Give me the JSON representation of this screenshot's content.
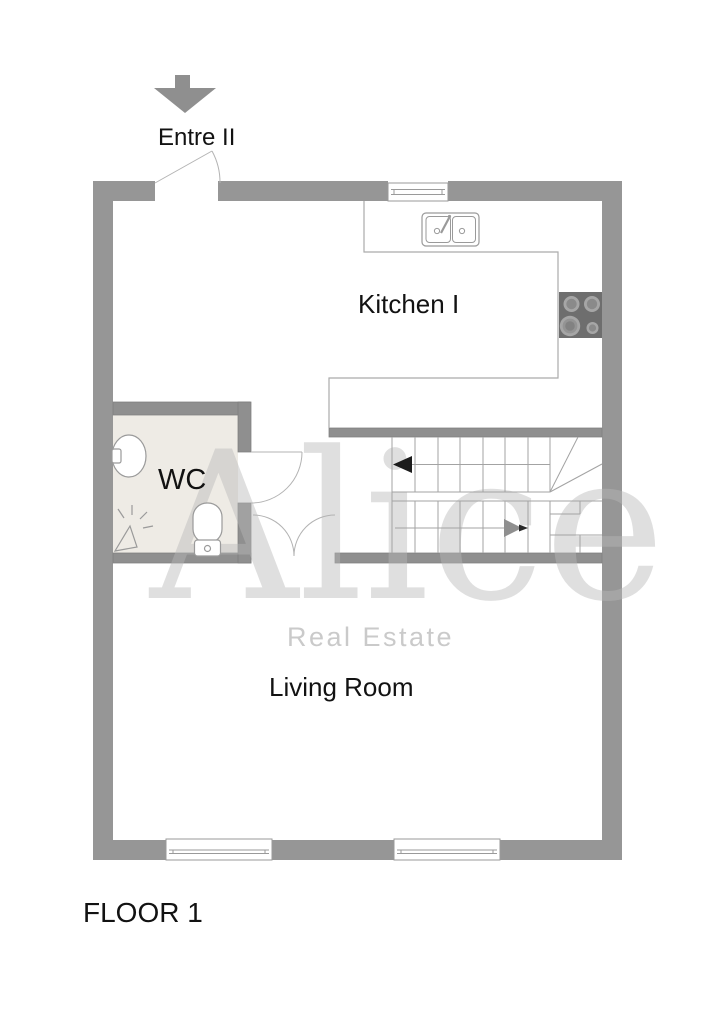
{
  "page": {
    "width": 724,
    "height": 1024,
    "background": "#ffffff"
  },
  "entry": {
    "label": "Entre II",
    "direction_icon": "down-arrow"
  },
  "rooms": {
    "kitchen": {
      "label": "Kitchen I"
    },
    "wc": {
      "label": "WC"
    },
    "living_room": {
      "label": "Living Room"
    }
  },
  "floor": {
    "label": "FLOOR 1"
  },
  "watermark": {
    "brand": "Alice",
    "tagline": "Real Estate"
  },
  "stairs": {
    "up_walk_arrow": "left",
    "down_walk_arrow": "right"
  },
  "fixtures": [
    "kitchen-sink",
    "stove",
    "toilet",
    "washbasin",
    "wall-lamp",
    "window",
    "door-swing"
  ],
  "colors": {
    "wall": "#969696",
    "interior_wall": "#8f8f8f",
    "wc_floor": "#eeebe5",
    "stove": "#6e6e6e",
    "plan_line": "#a8a8a8",
    "text": "#121212",
    "watermark_brand": "#e4e4e4",
    "watermark_tagline": "#d9d9d9"
  }
}
